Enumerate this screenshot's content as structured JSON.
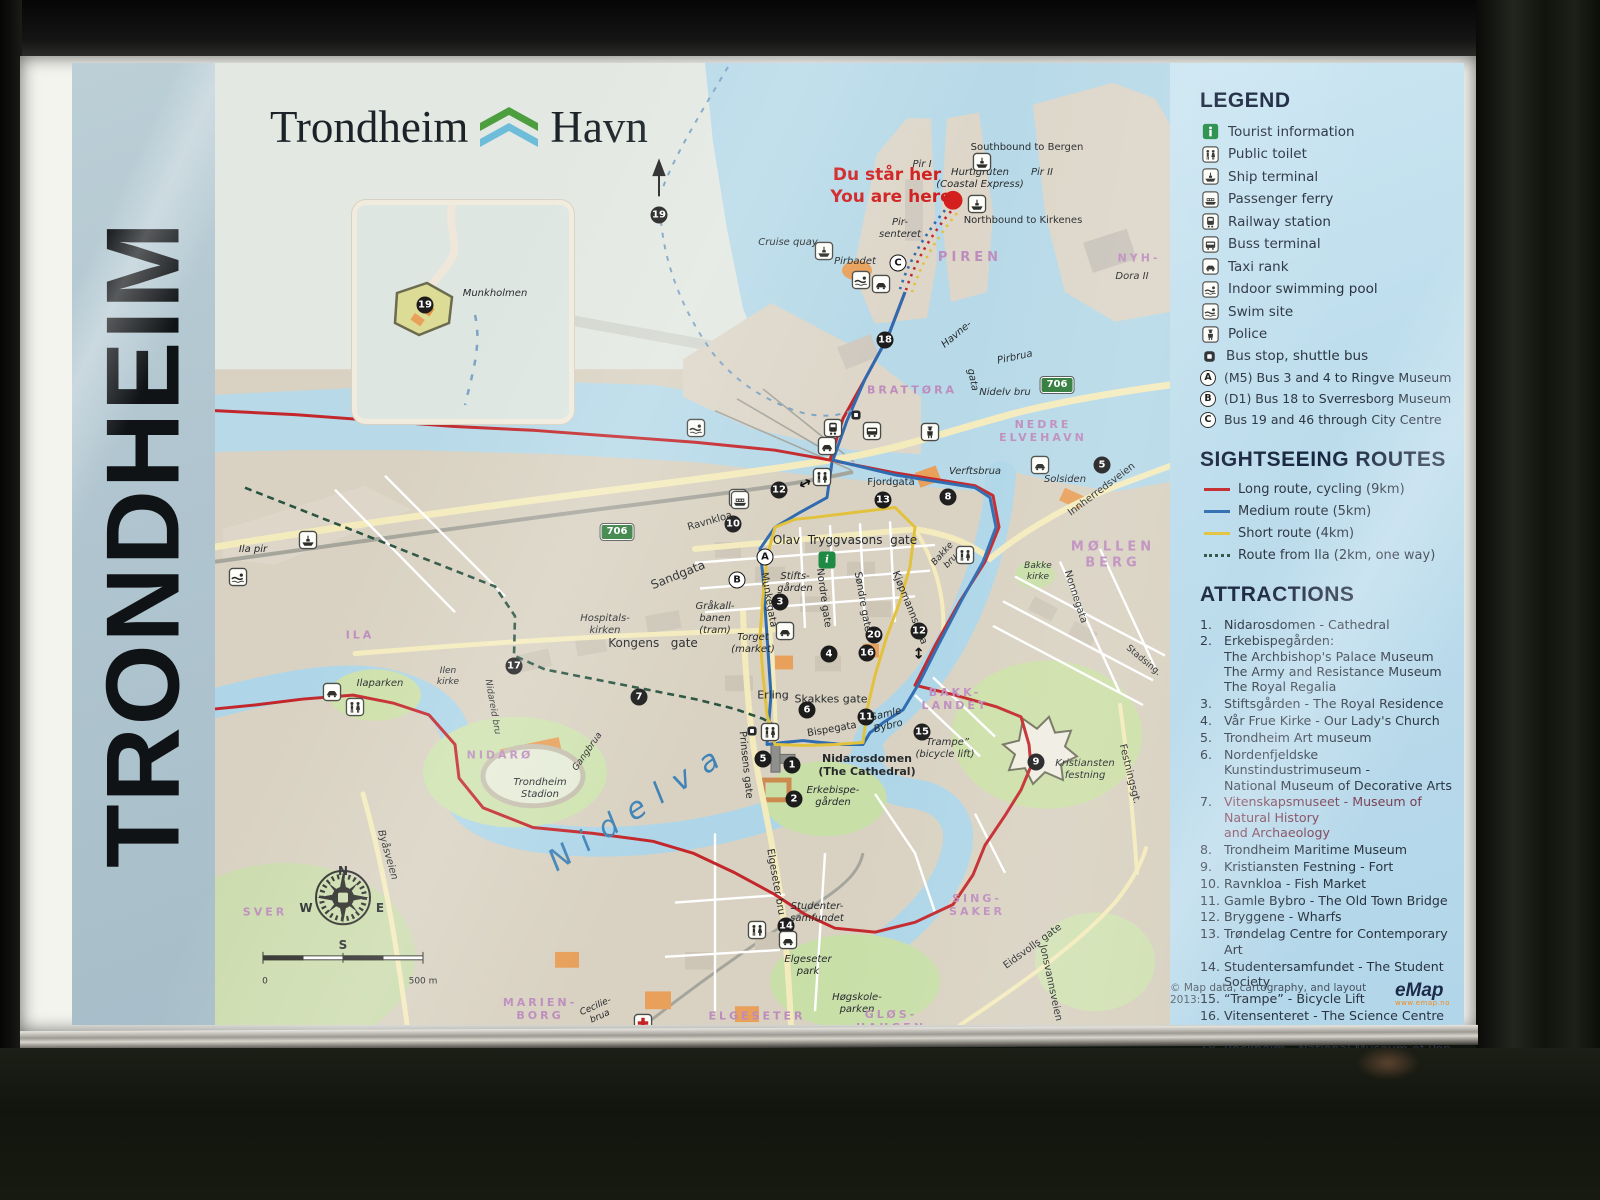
{
  "sidebar": {
    "vertical_title": "TRONDHEIM"
  },
  "header": {
    "title_left": "Trondheim",
    "title_right": "Havn"
  },
  "you_are_here": {
    "line1": "Du står her",
    "line2": "You are here"
  },
  "inset": {
    "island_label": "Munkholmen"
  },
  "legend": {
    "heading": "LEGEND",
    "items": [
      {
        "icon": "tourist-information-icon",
        "label": "Tourist information"
      },
      {
        "icon": "public-toilet-icon",
        "label": "Public toilet"
      },
      {
        "icon": "ship-terminal-icon",
        "label": "Ship terminal"
      },
      {
        "icon": "passenger-ferry-icon",
        "label": "Passenger ferry"
      },
      {
        "icon": "railway-station-icon",
        "label": "Railway station"
      },
      {
        "icon": "bus-terminal-icon",
        "label": "Buss terminal"
      },
      {
        "icon": "taxi-rank-icon",
        "label": "Taxi rank"
      },
      {
        "icon": "indoor-swimming-pool-icon",
        "label": "Indoor swimming pool"
      },
      {
        "icon": "swim-site-icon",
        "label": "Swim site"
      },
      {
        "icon": "police-icon",
        "label": "Police"
      },
      {
        "icon": "bus-stop-icon",
        "label": "Bus stop, shuttle bus"
      }
    ],
    "bus_routes": [
      {
        "badge": "A",
        "label": "(M5) Bus 3 and 4 to Ringve Museum"
      },
      {
        "badge": "B",
        "label": "(D1) Bus 18 to Sverresborg Museum"
      },
      {
        "badge": "C",
        "label": "Bus 19 and 46 through City Centre"
      }
    ]
  },
  "routes": {
    "heading": "SIGHTSEEING ROUTES",
    "items": [
      {
        "label": "Long route, cycling (9km)",
        "color": "#c3272b",
        "style": "solid"
      },
      {
        "label": "Medium route (5km)",
        "color": "#2e6bb0",
        "style": "solid"
      },
      {
        "label": "Short route (4km)",
        "color": "#e2c23c",
        "style": "solid"
      },
      {
        "label": "Route from Ila (2km, one way)",
        "color": "#2a5340",
        "style": "dashed"
      }
    ]
  },
  "attractions": {
    "heading": "ATTRACTIONS",
    "items": [
      {
        "num": "1.",
        "text": "Nidarosdomen - Cathedral"
      },
      {
        "num": "2.",
        "text": "Erkebispegården:\nThe Archbishop's Palace Museum\nThe Army and Resistance Museum\nThe Royal Regalia"
      },
      {
        "num": "3.",
        "text": "Stiftsgården - The Royal Residence"
      },
      {
        "num": "4.",
        "text": "Vår Frue Kirke - Our Lady's Church"
      },
      {
        "num": "5.",
        "text": "Trondheim Art museum"
      },
      {
        "num": "6.",
        "text": "Nordenfjeldske Kunstindustrimuseum -\nNational Museum of Decorative Arts"
      },
      {
        "num": "7.",
        "text": "Vitenskapsmuseet - Museum of Natural History\nand Archaeology"
      },
      {
        "num": "8.",
        "text": "Trondheim Maritime Museum"
      },
      {
        "num": "9.",
        "text": "Kristiansten Festning - Fort"
      },
      {
        "num": "10.",
        "text": "Ravnkloa - Fish Market"
      },
      {
        "num": "11.",
        "text": "Gamle Bybro - The Old Town Bridge"
      },
      {
        "num": "12.",
        "text": "Bryggene - Wharfs"
      },
      {
        "num": "13.",
        "text": "Trøndelag Centre for Contemporary Art"
      },
      {
        "num": "14.",
        "text": "Studentersamfundet - The Student Society"
      },
      {
        "num": "15.",
        "text": "“Trampe” - Bicycle Lift"
      },
      {
        "num": "16.",
        "text": "Vitensenteret - The Science Centre"
      },
      {
        "num": "17.",
        "text": "Trondheim Police Museum"
      },
      {
        "num": "18.",
        "text": "Rockheim - National Museum of Pop and Rock"
      },
      {
        "num": "19.",
        "text": "Munkholmen Island"
      },
      {
        "num": "20.",
        "text": "Medieval Church Ruins (in the Library)"
      },
      {
        "num": "21.",
        "text": "Sverresborg museum"
      },
      {
        "num": "22.",
        "text": "Ringve museum"
      }
    ]
  },
  "credit": {
    "text": "© Map data, cartography, and layout 2013:",
    "logo": "eMap",
    "logo_sub": "www.emap.no"
  },
  "map_markers": {
    "n1": "1",
    "n2": "2",
    "n3": "3",
    "n4": "4",
    "n5": "5",
    "n6": "6",
    "n7": "7",
    "n8": "8",
    "n9": "9",
    "n10": "10",
    "n11": "11",
    "n12": "12",
    "n13": "13",
    "n14": "14",
    "n15": "15",
    "n16": "16",
    "n17": "17",
    "n18": "18",
    "n19": "19",
    "n20": "20",
    "a": "A",
    "b": "B",
    "c": "C",
    "i": "i",
    "road_706": "706",
    "arrow": "↔",
    "compass_n": "N",
    "compass_e": "E",
    "compass_s": "S",
    "compass_w": "W",
    "scale_0": "0",
    "scale_500": "500 m"
  },
  "map_labels": {
    "southbound": "Southbound to Bergen",
    "northbound": "Northbound to Kirkenes",
    "hurtigruten": "Hurtigruten\n(Coastal Express)",
    "pir1": "Pir I",
    "pir2": "Pir II",
    "pirsenteret": "Pir-\nsenteret",
    "cruise_quay": "Cruise quay",
    "pirbadet": "Pirbadet",
    "piren": "PIREN",
    "nyhavna": "NYH-",
    "dora": "Dora II",
    "havnegata1": "Havne-",
    "havnegata2": "gata",
    "pirbrua": "Pirbrua",
    "brattora": "BRATTØRA",
    "nidelv_bru": "Nidelv bru",
    "nedre_elvehavn": "NEDRE\nELVEHAVN",
    "verftsbrua": "Verftsbrua",
    "solsiden": "Solsiden",
    "innherredsveien": "Innherredsveien",
    "mollenberg": "MØLLEN\nBERG",
    "bakke_kirke": "Bakke\nkirke",
    "nonnegata": "Nonnegata",
    "stadsing": "Stadsing.",
    "fjordgata": "Fjordgata",
    "olav_tryggvasons": "Olav  Tryggvasons  gate",
    "ravnkloa": "Ravnkloa",
    "sandgata": "Sandgata",
    "munkegata": "Munkegata",
    "nordre": "Nordre gate",
    "sondre": "Søndre gate",
    "kjopmannsgata": "Kjøpmannsgata",
    "stiftsgarden": "Stifts-\ngården",
    "grakallbanen": "Gråkall-\nbanen\n(tram)",
    "hospitalskirken": "Hospitals-\nkirken",
    "kongens": "Kongens   gate",
    "torget": "Torget\n(market)",
    "bakke_bru": "Bakke\nbru",
    "erling": "Erling",
    "skakkes": "Skakkes gate",
    "bispegata": "Bispegata",
    "gamle_bybro": "Gamle\nBybro",
    "trampe": "“Trampe”\n(bicycle lift)",
    "nidarosdomen": "Nidarosdomen\n(The Cathedral)",
    "erkebispegarden": "Erkebispe-\ngården",
    "prinsens": "Prinsens gate",
    "nidelva": "Nidelva",
    "gangbrua": "Gangbrua",
    "nidareid": "Nidareid bru",
    "nidaro": "NIDARØ",
    "stadion": "Trondheim\nStadion",
    "ilen_kirke": "Ilen\nkirke",
    "ilaparken": "Ilaparken",
    "ila": "ILA",
    "ila_pir": "Ila pir",
    "bakklandet": "BAKK-\nLANDET",
    "kristiansten": "Kristiansten\nfestning",
    "festningsgt": "Festningsgt.",
    "singsaker": "SING-\nSAKER",
    "eidsvolls": "Eidsvolls gate",
    "jonsvannsveien": "Jonsvannsveien",
    "elgeseter_bru": "Elgeseter bru",
    "studentersamfundet": "Studenter-\nsamfundet",
    "elgeseter_park": "Elgeseter\npark",
    "hogskoleparken": "Høgskole-\nparken",
    "elgeseter": "ELGESETER",
    "gloshaugen": "GLØS-\nHAUGEN",
    "marienborg": "MARIEN-\nBORG",
    "ceciliebrua": "Cecilie-\nbrua",
    "sverresborg": "SVER",
    "byasveien": "Byåsveien",
    "munkholmen": "Munkholmen"
  }
}
